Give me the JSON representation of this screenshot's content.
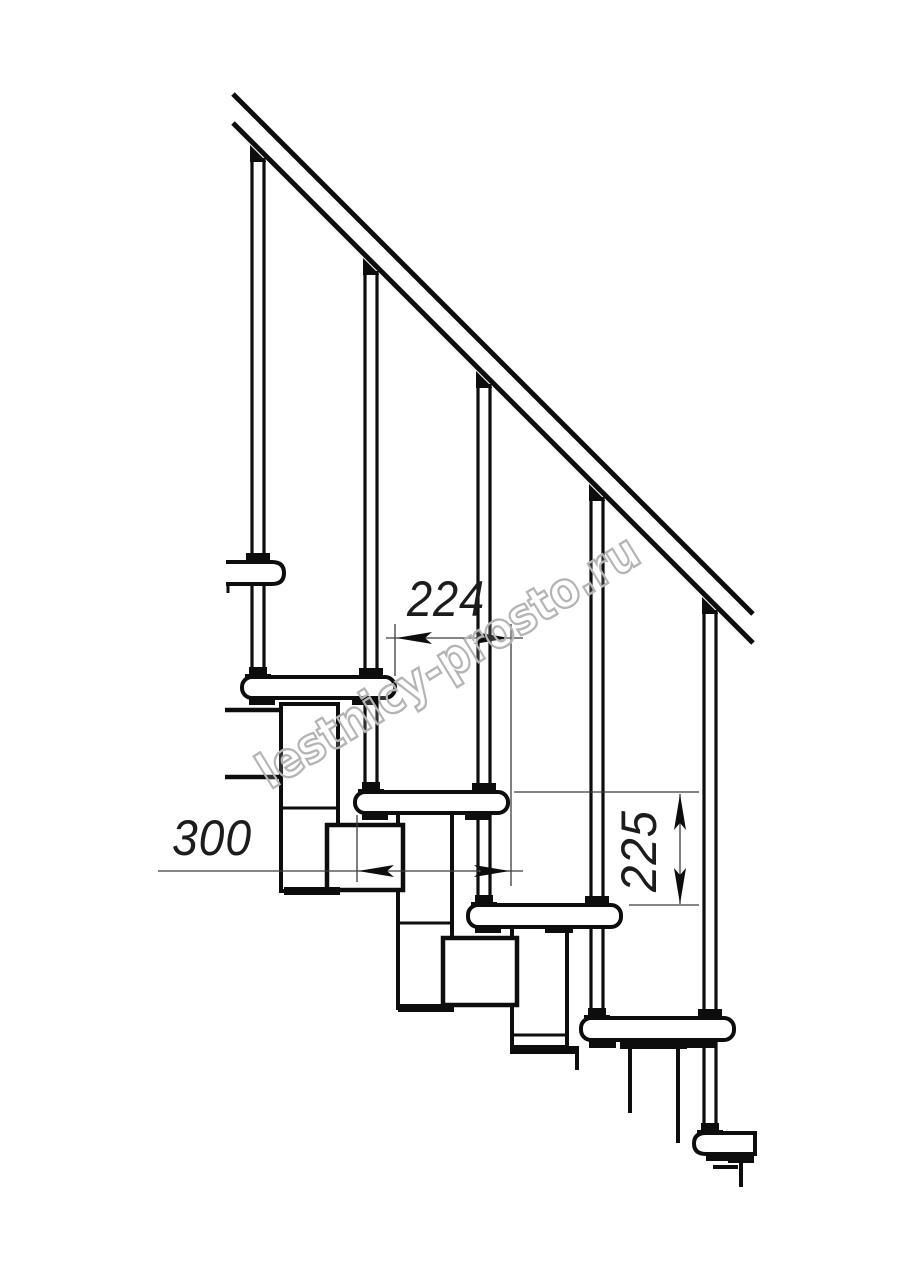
{
  "watermark": {
    "text": "lestnicy-prosto.ru",
    "color": "#b4b4b4",
    "rotation_deg": -31.5
  },
  "dimensions": {
    "going": {
      "label": "224",
      "value": 224,
      "orientation": "horizontal",
      "description": "horizontal offset between consecutive tread noses"
    },
    "tread_depth": {
      "label": "300",
      "value": 300,
      "orientation": "horizontal",
      "description": "tread depth"
    },
    "rise": {
      "label": "225",
      "value": 225,
      "orientation": "vertical",
      "description": "rise between treads"
    }
  },
  "style": {
    "ink": "#0d0d0d",
    "dim_ink": "#3c3c3c",
    "paper": "#ffffff"
  },
  "drawing": {
    "description": "side-view technical drawing of a modular staircase: diagonal handrail, five balusters, five treads descending left to right, central stringer modules, dimension annotations",
    "shapes": [
      {
        "t": "line",
        "name": "collar-none",
        "skip": true
      },
      {
        "t": "rect",
        "name": "baluster-collar-1",
        "x": 246,
        "y": 553,
        "w": 24,
        "h": 9,
        "fill": "ink"
      },
      {
        "t": "rect",
        "name": "baluster-collar-2",
        "x": 359,
        "y": 668,
        "w": 24,
        "h": 9,
        "fill": "ink"
      },
      {
        "t": "rect",
        "name": "baluster-collar-3",
        "x": 472,
        "y": 783,
        "w": 24,
        "h": 9,
        "fill": "ink"
      },
      {
        "t": "rect",
        "name": "baluster-collar-4",
        "x": 585,
        "y": 896,
        "w": 24,
        "h": 9,
        "fill": "ink"
      },
      {
        "t": "rect",
        "name": "baluster-collar-5",
        "x": 698,
        "y": 1009,
        "w": 24,
        "h": 9,
        "fill": "ink"
      },
      {
        "t": "line",
        "name": "baluster-1-left",
        "x1": 252,
        "y1": 158,
        "x2": 252,
        "y2": 670,
        "w": 3.2
      },
      {
        "t": "line",
        "name": "baluster-1-right",
        "x1": 264,
        "y1": 158,
        "x2": 264,
        "y2": 670,
        "w": 3.2
      },
      {
        "t": "poly",
        "name": "baluster-1-cap",
        "pts": "250,145 266,161 266,162 250,162",
        "fill": "ink"
      },
      {
        "t": "line",
        "name": "baluster-2-left",
        "x1": 365,
        "y1": 271,
        "x2": 365,
        "y2": 785,
        "w": 3.2
      },
      {
        "t": "line",
        "name": "baluster-2-right",
        "x1": 377,
        "y1": 271,
        "x2": 377,
        "y2": 785,
        "w": 3.2
      },
      {
        "t": "poly",
        "name": "baluster-2-cap",
        "pts": "363,258 379,274 379,275 363,275",
        "fill": "ink"
      },
      {
        "t": "line",
        "name": "baluster-3-left",
        "x1": 478,
        "y1": 384,
        "x2": 478,
        "y2": 898,
        "w": 3.2
      },
      {
        "t": "line",
        "name": "baluster-3-right",
        "x1": 490,
        "y1": 384,
        "x2": 490,
        "y2": 898,
        "w": 3.2
      },
      {
        "t": "poly",
        "name": "baluster-3-cap",
        "pts": "476,371 492,387 492,388 476,388",
        "fill": "ink"
      },
      {
        "t": "line",
        "name": "baluster-4-left",
        "x1": 591,
        "y1": 497,
        "x2": 591,
        "y2": 1011,
        "w": 3.2
      },
      {
        "t": "line",
        "name": "baluster-4-right",
        "x1": 603,
        "y1": 497,
        "x2": 603,
        "y2": 1011,
        "w": 3.2
      },
      {
        "t": "poly",
        "name": "baluster-4-cap",
        "pts": "589,484 605,500 605,501 589,501",
        "fill": "ink"
      },
      {
        "t": "line",
        "name": "baluster-5-left",
        "x1": 704,
        "y1": 610,
        "x2": 704,
        "y2": 1126,
        "w": 3.2
      },
      {
        "t": "line",
        "name": "baluster-5-right",
        "x1": 716,
        "y1": 610,
        "x2": 716,
        "y2": 1126,
        "w": 3.2
      },
      {
        "t": "poly",
        "name": "baluster-5-cap",
        "pts": "702,597 718,613 718,614 702,614",
        "fill": "ink"
      },
      {
        "t": "line",
        "name": "handrail-top-line",
        "x1": 233,
        "y1": 94,
        "x2": 753,
        "y2": 614,
        "w": 5
      },
      {
        "t": "line",
        "name": "handrail-bottom-line",
        "x1": 233,
        "y1": 123,
        "x2": 753,
        "y2": 643,
        "w": 5
      },
      {
        "t": "rect",
        "name": "stringer-module-1",
        "x": 281,
        "y": 704,
        "w": 57,
        "h": 187,
        "fill": "paper",
        "stroke": "ink",
        "sw": 4
      },
      {
        "t": "line",
        "name": "stringer-module-1-joint",
        "x1": 281,
        "y1": 808,
        "x2": 338,
        "y2": 808,
        "w": 3
      },
      {
        "t": "rect",
        "name": "stringer-module-2",
        "x": 398,
        "y": 813,
        "w": 54,
        "h": 195,
        "fill": "paper",
        "stroke": "ink",
        "sw": 4
      },
      {
        "t": "line",
        "name": "stringer-module-2-joint",
        "x1": 398,
        "y1": 923,
        "x2": 452,
        "y2": 923,
        "w": 3
      },
      {
        "t": "rect",
        "name": "stringer-module-3",
        "x": 512,
        "y": 927,
        "w": 55,
        "h": 125,
        "fill": "paper",
        "stroke": "ink",
        "sw": 4
      },
      {
        "t": "line",
        "name": "stringer-module-3-joint",
        "x1": 512,
        "y1": 1035,
        "x2": 567,
        "y2": 1035,
        "w": 3
      },
      {
        "t": "line",
        "name": "stringer-module-4-left-edge",
        "x1": 630,
        "y1": 1048,
        "x2": 630,
        "y2": 1113,
        "w": 4
      },
      {
        "t": "line",
        "name": "stringer-module-4-right-edge",
        "x1": 678,
        "y1": 1045,
        "x2": 678,
        "y2": 1143,
        "w": 4
      },
      {
        "t": "rect",
        "name": "stringer-module-4-top-bar",
        "x": 620,
        "y": 1041,
        "w": 67,
        "h": 8,
        "fill": "ink"
      },
      {
        "t": "rect",
        "name": "connector-box-1",
        "x": 327,
        "y": 825,
        "w": 76,
        "h": 65,
        "fill": "paper",
        "stroke": "ink",
        "sw": 4.5
      },
      {
        "t": "rect",
        "name": "connector-box-2",
        "x": 443,
        "y": 938,
        "w": 74,
        "h": 67,
        "fill": "paper",
        "stroke": "ink",
        "sw": 4.5
      },
      {
        "t": "rect",
        "name": "module-1-bottom-bar",
        "x": 284,
        "y": 887,
        "w": 56,
        "h": 8,
        "fill": "ink"
      },
      {
        "t": "rect",
        "name": "module-2-bottom-bar",
        "x": 398,
        "y": 1004,
        "w": 56,
        "h": 8,
        "fill": "ink"
      },
      {
        "t": "rect",
        "name": "module-3-bottom-bar",
        "x": 513,
        "y": 1045,
        "w": 55,
        "h": 8,
        "fill": "ink"
      },
      {
        "t": "rect",
        "name": "module-3-hook-bar",
        "x": 553,
        "y": 1046,
        "w": 26,
        "h": 8,
        "fill": "ink"
      },
      {
        "t": "line",
        "name": "module-3-hook-line",
        "x1": 577,
        "y1": 1050,
        "x2": 577,
        "y2": 1070,
        "w": 4
      },
      {
        "t": "rect",
        "name": "tread-1",
        "x": 242,
        "y": 677,
        "w": 153,
        "h": 21,
        "rx": 10,
        "fill": "paper",
        "stroke": "ink",
        "sw": 4
      },
      {
        "t": "rect",
        "name": "tread-2",
        "x": 355,
        "y": 792,
        "w": 153,
        "h": 21,
        "rx": 10,
        "fill": "paper",
        "stroke": "ink",
        "sw": 4
      },
      {
        "t": "rect",
        "name": "tread-3",
        "x": 468,
        "y": 905,
        "w": 153,
        "h": 22,
        "rx": 10,
        "fill": "paper",
        "stroke": "ink",
        "sw": 4
      },
      {
        "t": "rect",
        "name": "tread-4",
        "x": 581,
        "y": 1018,
        "w": 153,
        "h": 22,
        "rx": 10,
        "fill": "paper",
        "stroke": "ink",
        "sw": 4
      },
      {
        "t": "path",
        "name": "tread-5-cut",
        "d": "M755 1133 H706 Q694 1133 694 1143.5 Q694 1154 706 1154 H755 Z",
        "fill": "paper",
        "stroke": "ink",
        "sw": 4
      },
      {
        "t": "rect",
        "name": "tread-1-tab-left",
        "x": 249,
        "y": 697,
        "w": 26,
        "h": 8,
        "fill": "ink"
      },
      {
        "t": "rect",
        "name": "tread-1-tab-right",
        "x": 352,
        "y": 697,
        "w": 25,
        "h": 8,
        "fill": "ink"
      },
      {
        "t": "rect",
        "name": "tread-2-tab-left",
        "x": 362,
        "y": 812,
        "w": 26,
        "h": 8,
        "fill": "ink"
      },
      {
        "t": "rect",
        "name": "tread-2-tab-right",
        "x": 465,
        "y": 812,
        "w": 26,
        "h": 8,
        "fill": "ink"
      },
      {
        "t": "rect",
        "name": "tread-3-tab-left",
        "x": 475,
        "y": 925,
        "w": 26,
        "h": 8,
        "fill": "ink"
      },
      {
        "t": "rect",
        "name": "tread-3-tab-right",
        "x": 545,
        "y": 925,
        "w": 28,
        "h": 8,
        "fill": "ink"
      },
      {
        "t": "rect",
        "name": "tread-4-tab-left",
        "x": 589,
        "y": 1040,
        "w": 27,
        "h": 8,
        "fill": "ink"
      },
      {
        "t": "rect",
        "name": "tread-4-tab-right",
        "x": 684,
        "y": 1040,
        "w": 31,
        "h": 8,
        "fill": "ink"
      },
      {
        "t": "rect",
        "name": "tread-5-tab",
        "x": 706,
        "y": 1152,
        "w": 25,
        "h": 9,
        "fill": "ink"
      },
      {
        "t": "poly",
        "name": "baluster-1-foot",
        "pts": "245,678 245,674 249,674 249,667 267,667 267,674 271,674 271,678",
        "fill": "ink"
      },
      {
        "t": "poly",
        "name": "baluster-2-foot",
        "pts": "358,793 358,789 362,789 362,782 380,782 380,789 384,789 384,793",
        "fill": "ink"
      },
      {
        "t": "poly",
        "name": "baluster-3-foot",
        "pts": "471,906 471,902 475,902 475,895 493,895 493,902 497,902 497,906",
        "fill": "ink"
      },
      {
        "t": "poly",
        "name": "baluster-4-foot",
        "pts": "584,1019 584,1015 588,1015 588,1008 606,1008 606,1015 610,1015 610,1019",
        "fill": "ink"
      },
      {
        "t": "poly",
        "name": "baluster-5-foot",
        "pts": "697,1134 697,1130 701,1130 701,1123 719,1123 719,1130 723,1130 723,1134",
        "fill": "ink"
      },
      {
        "t": "path",
        "name": "rail-end-cap",
        "d": "M226 562 H272 Q284 562 284 573 Q284 584 272 584 H226",
        "fill": "paper",
        "stroke": "ink",
        "sw": 4
      },
      {
        "t": "line",
        "name": "rail-end-cap-tick",
        "x1": 228,
        "y1": 584,
        "x2": 228,
        "y2": 593,
        "w": 3
      },
      {
        "t": "line",
        "name": "side-fragment-top",
        "x1": 225,
        "y1": 710,
        "x2": 283,
        "y2": 710,
        "w": 4.5
      },
      {
        "t": "line",
        "name": "side-fragment-bottom",
        "x1": 225,
        "y1": 777,
        "x2": 283,
        "y2": 777,
        "w": 4.5
      },
      {
        "t": "line",
        "name": "tread5-hook-h",
        "x1": 713,
        "y1": 1167,
        "x2": 738,
        "y2": 1167,
        "w": 4
      },
      {
        "t": "line",
        "name": "tread5-hook-v",
        "x1": 741,
        "y1": 1159,
        "x2": 741,
        "y2": 1187,
        "w": 4
      },
      {
        "t": "rect",
        "name": "tread5-hook-bar",
        "x": 728,
        "y": 1154,
        "w": 26,
        "h": 9,
        "fill": "ink"
      },
      {
        "t": "line",
        "name": "dim-224-ext-left",
        "x1": 395,
        "y1": 624,
        "x2": 395,
        "y2": 676,
        "w": 1.3,
        "stroke": "dim"
      },
      {
        "t": "line",
        "name": "dim-224-ext-right",
        "x1": 511,
        "y1": 624,
        "x2": 511,
        "y2": 886,
        "w": 1.3,
        "stroke": "dim"
      },
      {
        "t": "line",
        "name": "dim-224-line",
        "x1": 386,
        "y1": 638,
        "x2": 523,
        "y2": 638,
        "w": 1.3,
        "stroke": "dim"
      },
      {
        "t": "poly",
        "name": "dim-224-arrow-left",
        "pts": "396,638 432,632 425,638 432,644",
        "fill": "ink"
      },
      {
        "t": "poly",
        "name": "dim-224-arrow-right",
        "pts": "510,638 474,632 481,638 474,644",
        "fill": "ink"
      },
      {
        "t": "line",
        "name": "dim-300-ext-left",
        "x1": 357,
        "y1": 815,
        "x2": 357,
        "y2": 882,
        "w": 1.3,
        "stroke": "dim"
      },
      {
        "t": "line",
        "name": "dim-300-line",
        "x1": 158,
        "y1": 871,
        "x2": 523,
        "y2": 871,
        "w": 1.3,
        "stroke": "dim"
      },
      {
        "t": "poly",
        "name": "dim-300-arrow-left",
        "pts": "358,871 394,865 387,871 394,877",
        "fill": "ink"
      },
      {
        "t": "poly",
        "name": "dim-300-arrow-right",
        "pts": "510,871 474,865 481,871 474,877",
        "fill": "ink"
      },
      {
        "t": "line",
        "name": "dim-225-ext-top",
        "x1": 514,
        "y1": 792,
        "x2": 699,
        "y2": 792,
        "w": 1.3,
        "stroke": "dim"
      },
      {
        "t": "line",
        "name": "dim-225-ext-bottom",
        "x1": 629,
        "y1": 905,
        "x2": 699,
        "y2": 905,
        "w": 1.3,
        "stroke": "dim"
      },
      {
        "t": "line",
        "name": "dim-225-line",
        "x1": 680,
        "y1": 794,
        "x2": 680,
        "y2": 904,
        "w": 1.3,
        "stroke": "dim"
      },
      {
        "t": "poly",
        "name": "dim-225-arrow-up",
        "pts": "680,794 674,830 680,823 686,830",
        "fill": "ink"
      },
      {
        "t": "poly",
        "name": "dim-225-arrow-down",
        "pts": "680,904 674,868 680,875 686,868",
        "fill": "ink"
      }
    ]
  }
}
